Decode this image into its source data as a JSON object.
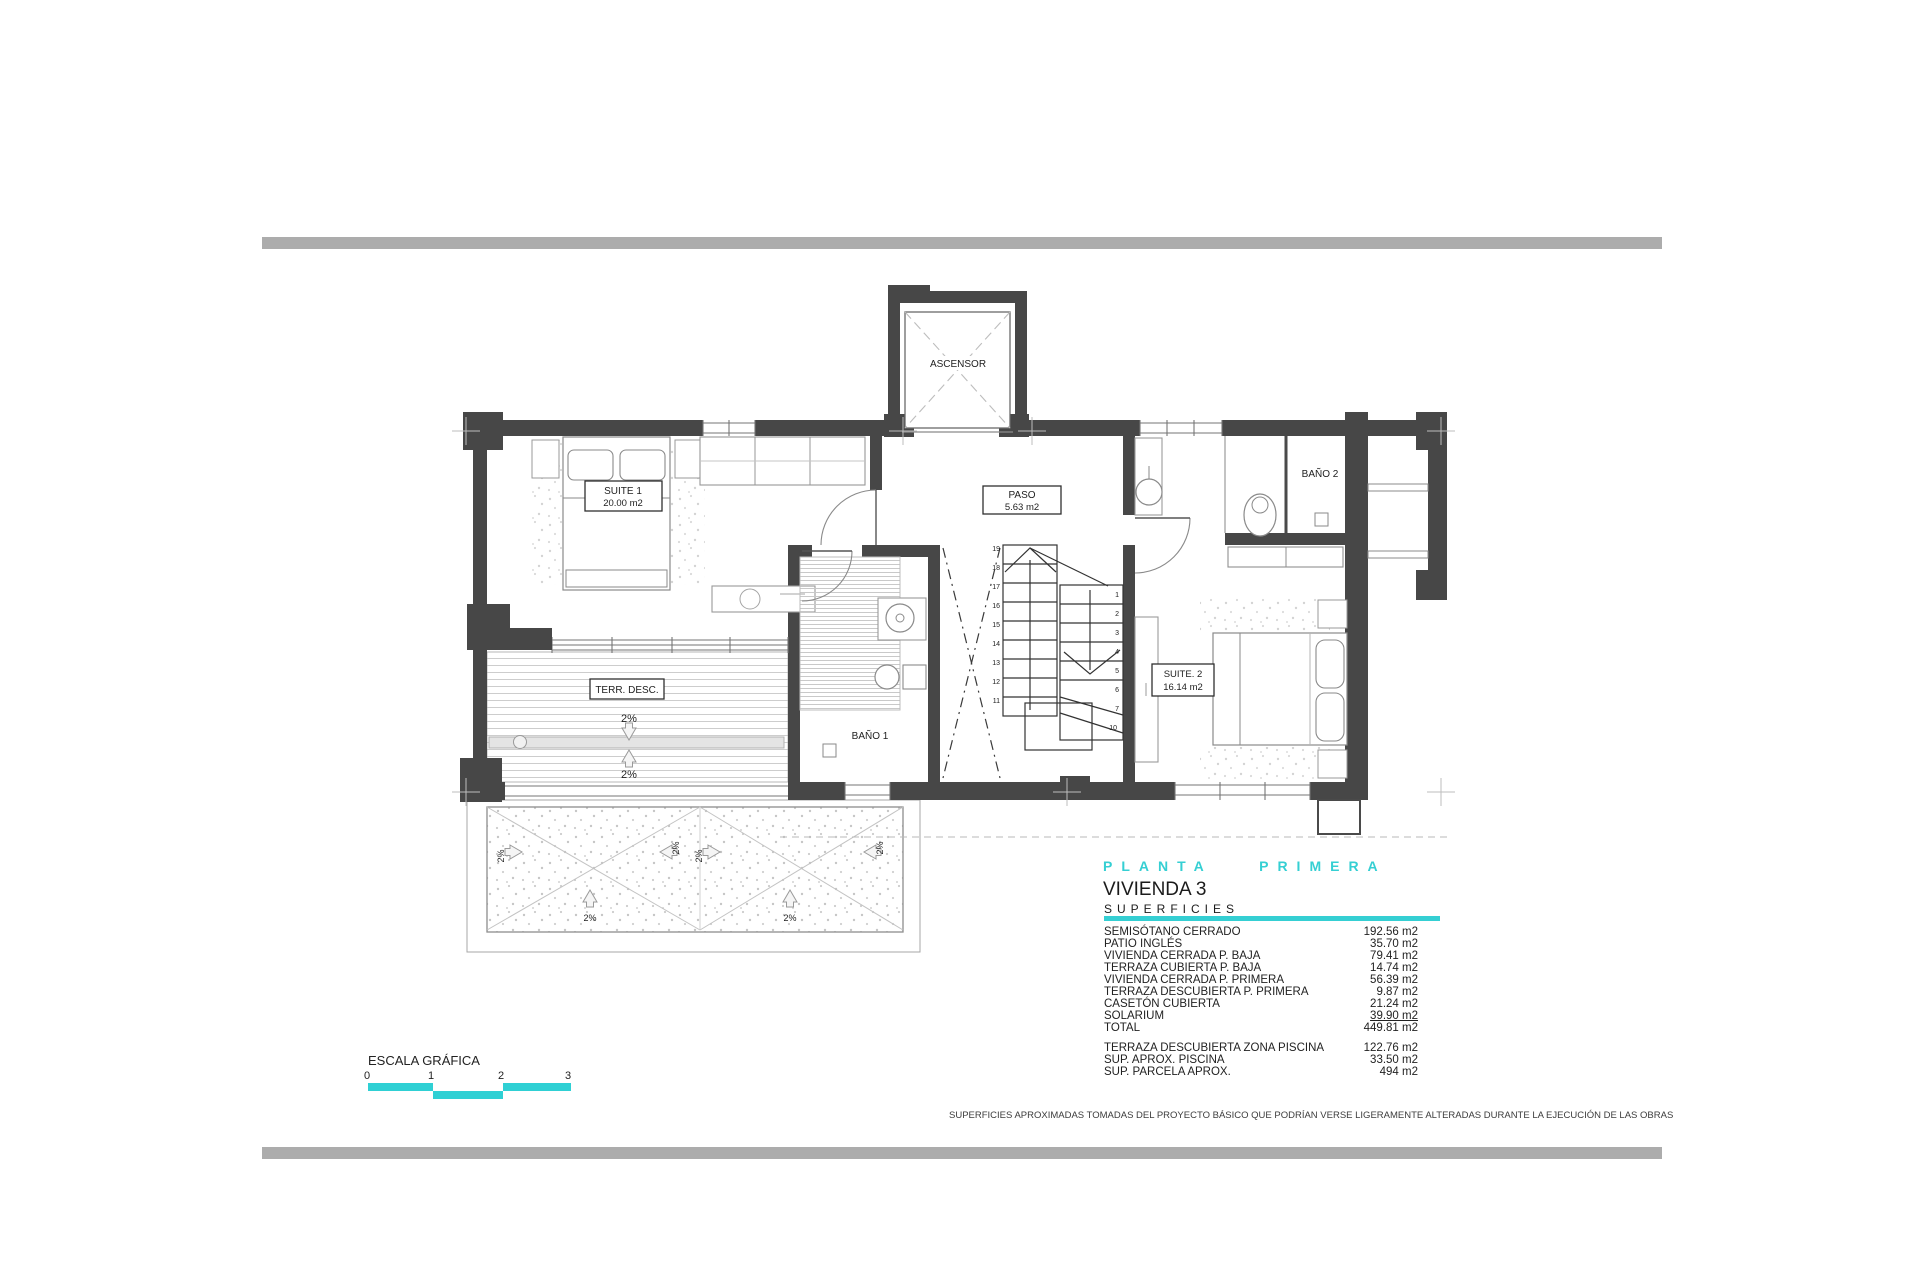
{
  "page": {
    "footer_note": "SUPERFICIES APROXIMADAS TOMADAS DEL PROYECTO BÁSICO QUE PODRÍAN VERSE LIGERAMENTE ALTERADAS DURANTE LA EJECUCIÓN DE LAS OBRAS"
  },
  "title_block": {
    "plan_title": "PLANTA PRIMERA",
    "unit_title": "VIVIENDA 3",
    "section_title": "SUPERFICIES",
    "accent_color": "#35cfd3"
  },
  "surfaces": {
    "rows": [
      {
        "label": "SEMISÓTANO CERRADO",
        "value": "192.56 m2"
      },
      {
        "label": "PATIO INGLÉS",
        "value": "35.70 m2"
      },
      {
        "label": "VIVIENDA CERRADA P. BAJA",
        "value": "79.41 m2"
      },
      {
        "label": "TERRAZA CUBIERTA P. BAJA",
        "value": "14.74 m2"
      },
      {
        "label": "VIVIENDA CERRADA P. PRIMERA",
        "value": "56.39 m2"
      },
      {
        "label": "TERRAZA DESCUBIERTA P. PRIMERA",
        "value": "9.87 m2"
      },
      {
        "label": "CASETÓN CUBIERTA",
        "value": "21.24 m2"
      },
      {
        "label": "SOLARIUM",
        "value": "39.90 m2"
      },
      {
        "label": "TOTAL",
        "value": "449.81 m2"
      }
    ],
    "extra_rows": [
      {
        "label": "TERRAZA DESCUBIERTA  ZONA PISCINA",
        "value": "122.76 m2"
      },
      {
        "label": "SUP.  APROX.  PISCINA",
        "value": "33.50 m2"
      },
      {
        "label": "SUP. PARCELA APROX.",
        "value": "494 m2"
      }
    ]
  },
  "scale_bar": {
    "label": "ESCALA GRÁFICA",
    "ticks": [
      "0",
      "1",
      "2",
      "3"
    ]
  },
  "plan": {
    "slope_label": "2%",
    "rooms": {
      "ascensor": {
        "name": "ASCENSOR"
      },
      "suite1": {
        "name": "SUITE 1",
        "area": "20.00 m2"
      },
      "paso": {
        "name": "PASO",
        "area": "5.63 m2"
      },
      "bano1": {
        "name": "BAÑO 1"
      },
      "bano2": {
        "name": "BAÑO 2"
      },
      "suite2": {
        "name": "SUITE. 2",
        "area": "16.14 m2"
      },
      "terraza": {
        "name": "TERR. DESC."
      }
    },
    "stairs": {
      "left_numbers": [
        "19",
        "18",
        "17",
        "16",
        "15",
        "14",
        "13",
        "12",
        "11"
      ],
      "right_numbers": [
        "1",
        "2",
        "3",
        "4",
        "5",
        "6",
        "7",
        "10"
      ]
    }
  }
}
